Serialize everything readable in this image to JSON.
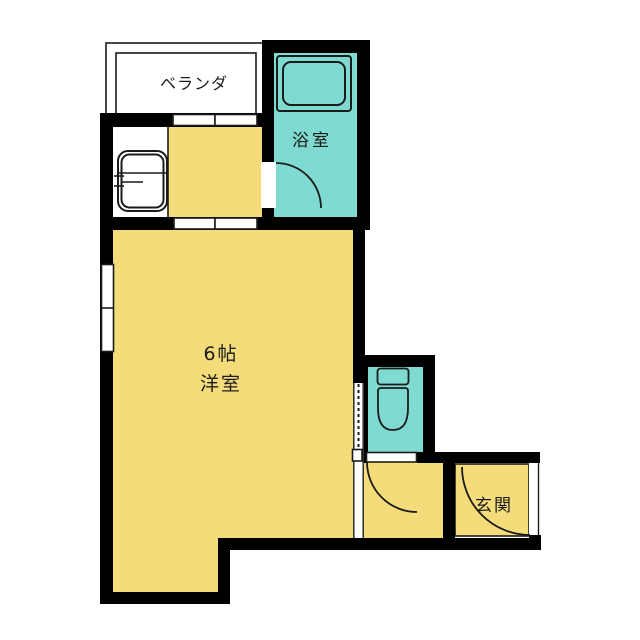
{
  "floorplan": {
    "type": "apartment-floor-plan",
    "labels": {
      "balcony": "ベランダ",
      "bathroom": "浴室",
      "main_room_size": "6帖",
      "main_room_type": "洋室",
      "entrance": "玄関"
    },
    "colors": {
      "room_fill": "#F5DC7B",
      "wet_area_fill": "#7FDAD1",
      "wall": "#000000",
      "line": "#1b1b1b",
      "background": "#FFFFFF"
    }
  }
}
